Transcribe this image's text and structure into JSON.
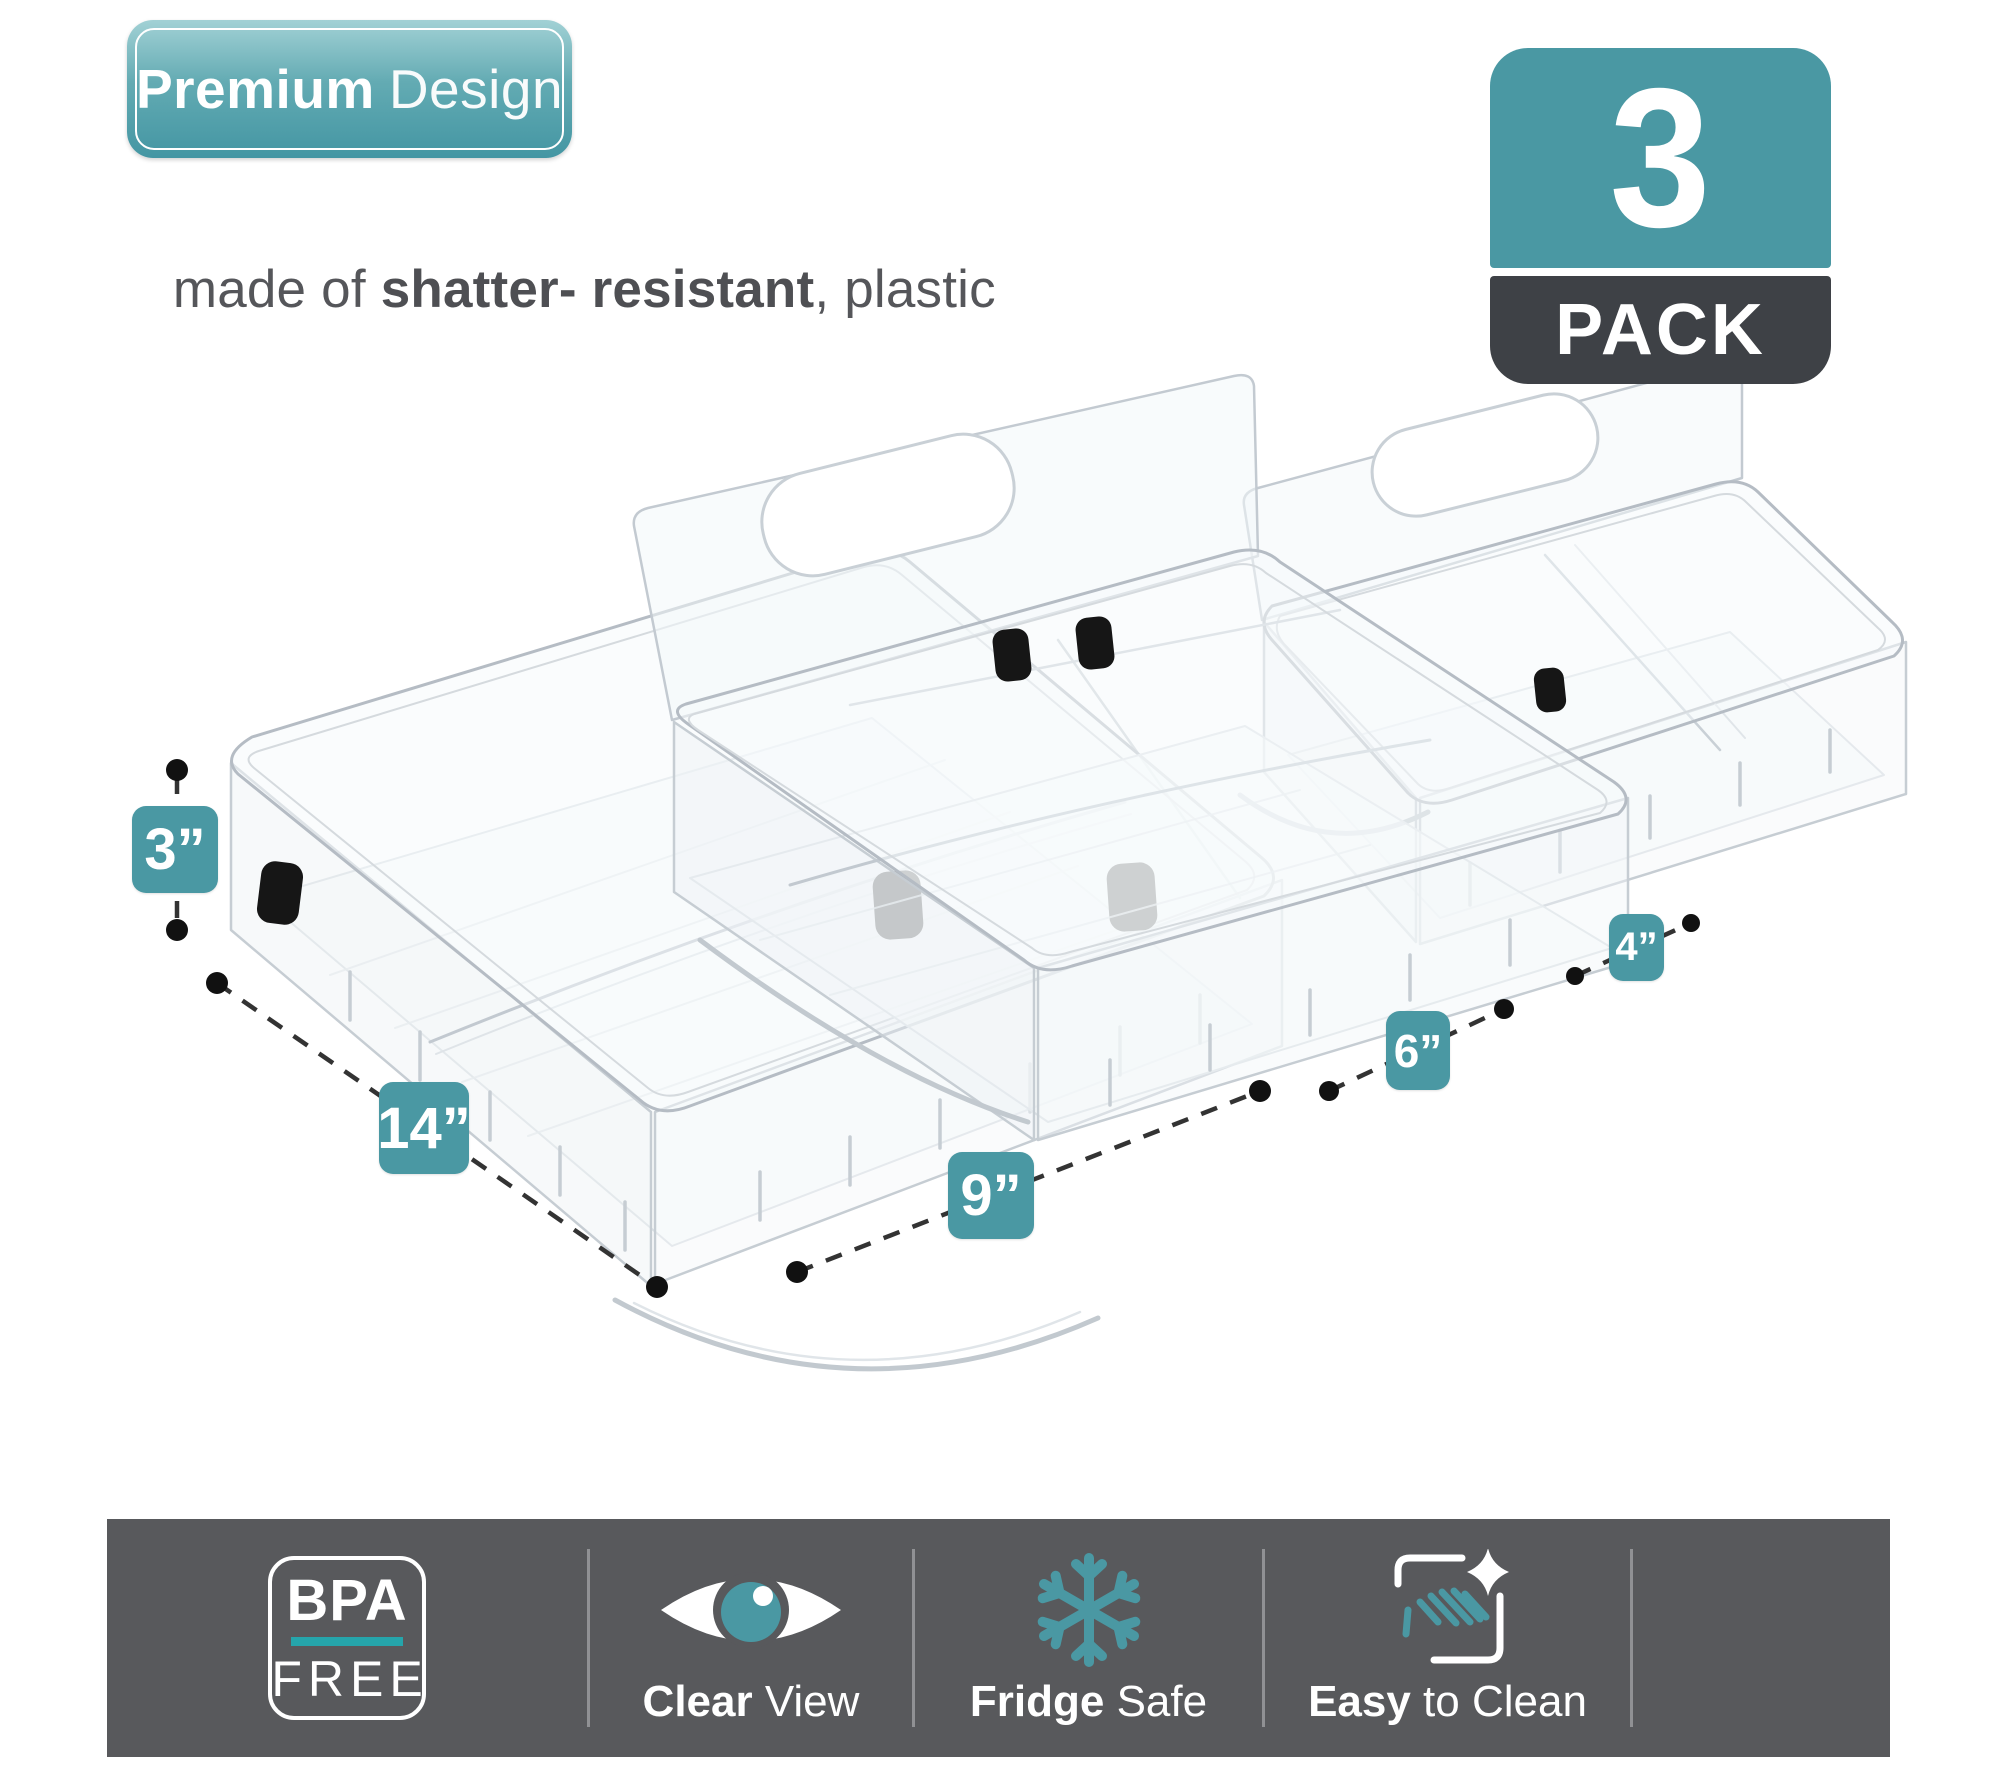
{
  "premium": {
    "title_bold": "Premium",
    "title_light": "Design",
    "subtitle_pre": "made of ",
    "subtitle_bold": "shatter- resistant",
    "subtitle_post": ", plastic"
  },
  "pack": {
    "count": "3",
    "label": "PACK"
  },
  "dimensions": {
    "height": "3”",
    "length": "14”",
    "width": "9”",
    "mid": "6”",
    "small": "4”"
  },
  "features": {
    "bpa_line1": "BPA",
    "bpa_line2": "FREE",
    "clear_bold": "Clear",
    "clear_rest": " View",
    "fridge_bold": "Fridge",
    "fridge_rest": " Safe",
    "easy_bold": "Easy",
    "easy_rest": " to Clean"
  },
  "colors": {
    "teal": "#4a98a3",
    "teal_bright": "#25a5ab",
    "pack_dark": "#3e4146",
    "bar_gray": "#58595c",
    "text_gray": "#55565a"
  }
}
